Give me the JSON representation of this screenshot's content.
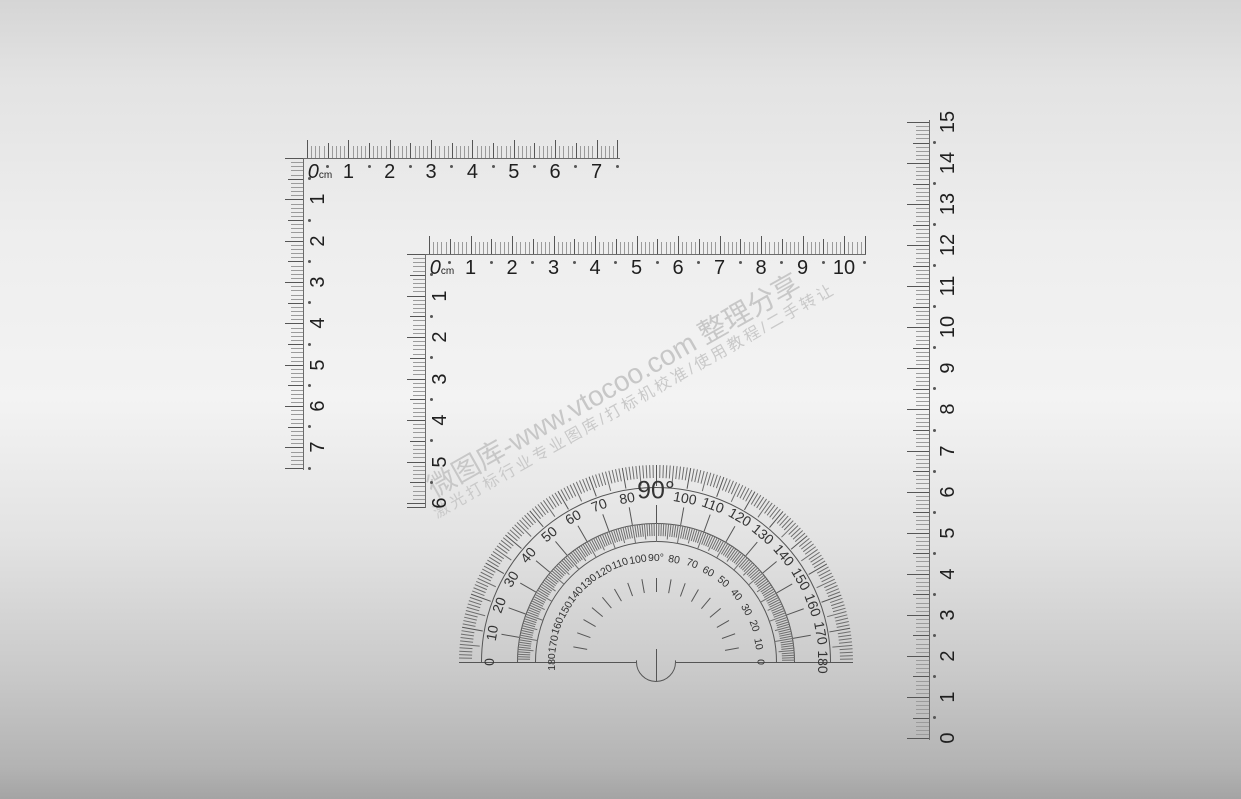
{
  "watermark": {
    "line1": "微图库-www.vtocoo.com 整理分享",
    "line2": "激光打标行业专业图库/打标机校准/使用教程/二手转让"
  },
  "ruler_top_left": {
    "zero_label": "0",
    "unit": "cm",
    "horizontal_numbers": [
      "1",
      "2",
      "3",
      "4",
      "5",
      "6",
      "7"
    ],
    "vertical_numbers": [
      "1",
      "2",
      "3",
      "4",
      "5",
      "6",
      "7"
    ]
  },
  "ruler_middle": {
    "zero_label": "0",
    "unit": "cm",
    "horizontal_numbers": [
      "1",
      "2",
      "3",
      "4",
      "5",
      "6",
      "7",
      "8",
      "9",
      "10"
    ],
    "vertical_numbers": [
      "1",
      "2",
      "3",
      "4",
      "5",
      "6"
    ]
  },
  "ruler_right": {
    "numbers": [
      "0",
      "1",
      "2",
      "3",
      "4",
      "5",
      "6",
      "7",
      "8",
      "9",
      "10",
      "11",
      "12",
      "13",
      "14",
      "15"
    ]
  },
  "protractor": {
    "outer_labels": [
      "0",
      "10",
      "20",
      "30",
      "40",
      "50",
      "60",
      "70",
      "80",
      "90°",
      "100",
      "110",
      "120",
      "130",
      "140",
      "150",
      "160",
      "170",
      "180"
    ],
    "inner_labels": [
      "180",
      "170",
      "160",
      "150",
      "140",
      "130",
      "120",
      "110",
      "100",
      "90°",
      "80",
      "70",
      "60",
      "50",
      "40",
      "30",
      "20",
      "10",
      "0"
    ]
  },
  "colors": {
    "tick_minor": "#9b9b9b",
    "tick_major": "#565656",
    "edge_line": "#6b6b6b",
    "number_color": "#1f1f1f",
    "protractor_tick": "#6e6e6e",
    "protractor_line": "#555555",
    "protractor_number": "#333333",
    "watermark_line1": "#c7c7c7",
    "watermark_line2": "#c9c9c9",
    "background_top": "#d5d5d5",
    "background_middle": "#f3f3f3",
    "background_bottom": "#a4a4a4"
  }
}
